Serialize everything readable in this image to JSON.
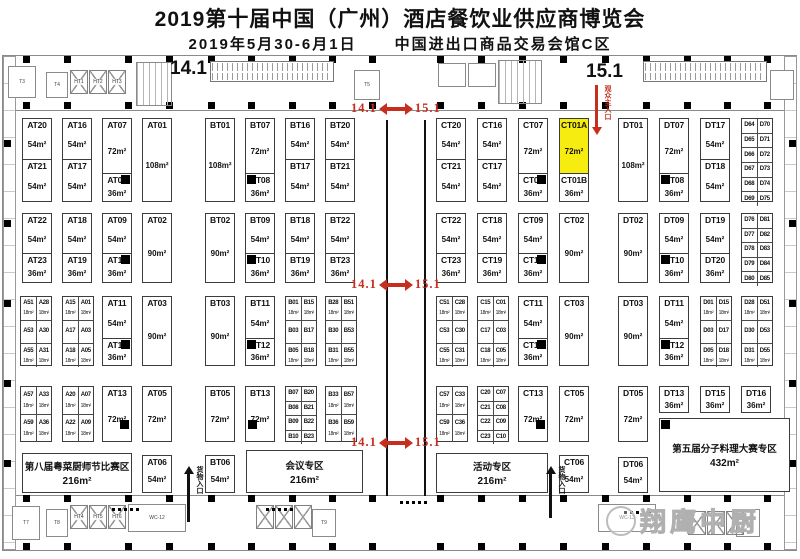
{
  "title": "2019第十届中国（广州）酒店餐饮业供应商博览会",
  "date": "2019年5月30-6月1日",
  "venue": "中国进出口商品交易会馆C区",
  "halls": {
    "left": "14.1",
    "right": "15.1"
  },
  "watermark": "翔鹰中厨",
  "markers": {
    "label_left": "14.1",
    "label_right": "15.1",
    "positions": [
      {
        "x": 351,
        "y": 101
      },
      {
        "x": 351,
        "y": 277
      },
      {
        "x": 351,
        "y": 435
      }
    ]
  },
  "entrances": {
    "main": {
      "label": "观众主入口",
      "x": 592,
      "y": 85,
      "h": 50
    },
    "goods": [
      {
        "label": "货物入口",
        "x": 184,
        "y": 466,
        "h": 56
      },
      {
        "label": "货物入口",
        "x": 546,
        "y": 466,
        "h": 52
      }
    ]
  },
  "zones": [
    {
      "label": "第八届粤菜厨师节比赛区",
      "size": "216m²",
      "x": 22,
      "y": 453,
      "w": 110,
      "h": 40
    },
    {
      "label": "会议专区",
      "size": "216m²",
      "x": 246,
      "y": 450,
      "w": 117,
      "h": 43
    },
    {
      "label": "活动专区",
      "size": "216m²",
      "x": 436,
      "y": 453,
      "w": 112,
      "h": 40
    },
    {
      "label": "第五届分子料理大赛专区",
      "size": "432m²",
      "x": 659,
      "y": 418,
      "w": 131,
      "h": 74,
      "pillar": "tl"
    }
  ],
  "booths": [
    {
      "id": "AT20",
      "size": "54m²",
      "x": 22,
      "y": 118,
      "w": 30,
      "h": 42
    },
    {
      "id": "AT21",
      "size": "54m²",
      "x": 22,
      "y": 159,
      "w": 30,
      "h": 43
    },
    {
      "id": "AT16",
      "size": "54m²",
      "x": 62,
      "y": 118,
      "w": 30,
      "h": 42
    },
    {
      "id": "AT17",
      "size": "54m²",
      "x": 62,
      "y": 159,
      "w": 30,
      "h": 43
    },
    {
      "id": "AT07",
      "size": "72m²",
      "x": 102,
      "y": 118,
      "w": 30,
      "h": 56
    },
    {
      "id": "AT08",
      "size": "36m²",
      "x": 102,
      "y": 173,
      "w": 30,
      "h": 29,
      "pillar": "tr"
    },
    {
      "id": "AT01",
      "size": "108m²",
      "x": 142,
      "y": 118,
      "w": 30,
      "h": 84
    },
    {
      "id": "AT22",
      "size": "54m²",
      "x": 22,
      "y": 213,
      "w": 30,
      "h": 41
    },
    {
      "id": "AT23",
      "size": "36m²",
      "x": 22,
      "y": 253,
      "w": 30,
      "h": 30
    },
    {
      "id": "AT18",
      "size": "54m²",
      "x": 62,
      "y": 213,
      "w": 30,
      "h": 41
    },
    {
      "id": "AT19",
      "size": "36m²",
      "x": 62,
      "y": 253,
      "w": 30,
      "h": 30
    },
    {
      "id": "AT09",
      "size": "54m²",
      "x": 102,
      "y": 213,
      "w": 30,
      "h": 41
    },
    {
      "id": "AT10",
      "size": "36m²",
      "x": 102,
      "y": 253,
      "w": 30,
      "h": 30,
      "pillar": "tr"
    },
    {
      "id": "AT02",
      "size": "90m²",
      "x": 142,
      "y": 213,
      "w": 30,
      "h": 70
    },
    {
      "id": "AT11",
      "size": "54m²",
      "x": 102,
      "y": 296,
      "w": 30,
      "h": 43
    },
    {
      "id": "AT12",
      "size": "36m²",
      "x": 102,
      "y": 338,
      "w": 30,
      "h": 28,
      "pillar": "tr"
    },
    {
      "id": "AT03",
      "size": "90m²",
      "x": 142,
      "y": 296,
      "w": 30,
      "h": 70
    },
    {
      "id": "AT13",
      "size": "72m²",
      "x": 102,
      "y": 386,
      "w": 30,
      "h": 56,
      "pillar": "br"
    },
    {
      "id": "AT05",
      "size": "72m²",
      "x": 142,
      "y": 386,
      "w": 30,
      "h": 56
    },
    {
      "id": "AT06",
      "size": "54m²",
      "x": 142,
      "y": 455,
      "w": 30,
      "h": 38
    },
    {
      "id": "BT01",
      "size": "108m²",
      "x": 205,
      "y": 118,
      "w": 30,
      "h": 84
    },
    {
      "id": "BT07",
      "size": "72m²",
      "x": 245,
      "y": 118,
      "w": 30,
      "h": 56
    },
    {
      "id": "BT08",
      "size": "36m²",
      "x": 245,
      "y": 173,
      "w": 30,
      "h": 29,
      "pillar": "tl"
    },
    {
      "id": "BT16",
      "size": "54m²",
      "x": 285,
      "y": 118,
      "w": 30,
      "h": 42
    },
    {
      "id": "BT17",
      "size": "54m²",
      "x": 285,
      "y": 159,
      "w": 30,
      "h": 43
    },
    {
      "id": "BT20",
      "size": "54m²",
      "x": 325,
      "y": 118,
      "w": 30,
      "h": 42
    },
    {
      "id": "BT21",
      "size": "54m²",
      "x": 325,
      "y": 159,
      "w": 30,
      "h": 43
    },
    {
      "id": "BT02",
      "size": "90m²",
      "x": 205,
      "y": 213,
      "w": 30,
      "h": 70
    },
    {
      "id": "BT09",
      "size": "54m²",
      "x": 245,
      "y": 213,
      "w": 30,
      "h": 41
    },
    {
      "id": "BT10",
      "size": "36m²",
      "x": 245,
      "y": 253,
      "w": 30,
      "h": 30,
      "pillar": "tl"
    },
    {
      "id": "BT18",
      "size": "54m²",
      "x": 285,
      "y": 213,
      "w": 30,
      "h": 41
    },
    {
      "id": "BT19",
      "size": "36m²",
      "x": 285,
      "y": 253,
      "w": 30,
      "h": 30
    },
    {
      "id": "BT22",
      "size": "54m²",
      "x": 325,
      "y": 213,
      "w": 30,
      "h": 41
    },
    {
      "id": "BT23",
      "size": "36m²",
      "x": 325,
      "y": 253,
      "w": 30,
      "h": 30
    },
    {
      "id": "BT03",
      "size": "90m²",
      "x": 205,
      "y": 296,
      "w": 30,
      "h": 70
    },
    {
      "id": "BT11",
      "size": "54m²",
      "x": 245,
      "y": 296,
      "w": 30,
      "h": 43
    },
    {
      "id": "BT12",
      "size": "36m²",
      "x": 245,
      "y": 338,
      "w": 30,
      "h": 28,
      "pillar": "tl"
    },
    {
      "id": "BT05",
      "size": "72m²",
      "x": 205,
      "y": 386,
      "w": 30,
      "h": 56
    },
    {
      "id": "BT13",
      "size": "72m²",
      "x": 245,
      "y": 386,
      "w": 30,
      "h": 56,
      "pillar": "bl"
    },
    {
      "id": "BT06",
      "size": "54m²",
      "x": 205,
      "y": 455,
      "w": 30,
      "h": 38
    },
    {
      "id": "CT20",
      "size": "54m²",
      "x": 436,
      "y": 118,
      "w": 30,
      "h": 42
    },
    {
      "id": "CT21",
      "size": "54m²",
      "x": 436,
      "y": 159,
      "w": 30,
      "h": 43
    },
    {
      "id": "CT16",
      "size": "54m²",
      "x": 477,
      "y": 118,
      "w": 30,
      "h": 42
    },
    {
      "id": "CT17",
      "size": "54m²",
      "x": 477,
      "y": 159,
      "w": 30,
      "h": 43
    },
    {
      "id": "CT07",
      "size": "72m²",
      "x": 518,
      "y": 118,
      "w": 30,
      "h": 56
    },
    {
      "id": "CT08",
      "size": "36m²",
      "x": 518,
      "y": 173,
      "w": 30,
      "h": 29,
      "pillar": "tr"
    },
    {
      "id": "CT01A",
      "size": "72m²",
      "x": 559,
      "y": 118,
      "w": 30,
      "h": 56,
      "hl": true
    },
    {
      "id": "CT01B",
      "size": "36m²",
      "x": 559,
      "y": 173,
      "w": 30,
      "h": 29
    },
    {
      "id": "CT22",
      "size": "54m²",
      "x": 436,
      "y": 213,
      "w": 30,
      "h": 41
    },
    {
      "id": "CT23",
      "size": "36m²",
      "x": 436,
      "y": 253,
      "w": 30,
      "h": 30
    },
    {
      "id": "CT18",
      "size": "54m²",
      "x": 477,
      "y": 213,
      "w": 30,
      "h": 41
    },
    {
      "id": "CT19",
      "size": "36m²",
      "x": 477,
      "y": 253,
      "w": 30,
      "h": 30
    },
    {
      "id": "CT09",
      "size": "54m²",
      "x": 518,
      "y": 213,
      "w": 30,
      "h": 41
    },
    {
      "id": "CT10",
      "size": "36m²",
      "x": 518,
      "y": 253,
      "w": 30,
      "h": 30,
      "pillar": "tr"
    },
    {
      "id": "CT02",
      "size": "90m²",
      "x": 559,
      "y": 213,
      "w": 30,
      "h": 70
    },
    {
      "id": "CT11",
      "size": "54m²",
      "x": 518,
      "y": 296,
      "w": 30,
      "h": 43
    },
    {
      "id": "CT12",
      "size": "36m²",
      "x": 518,
      "y": 338,
      "w": 30,
      "h": 28,
      "pillar": "tr"
    },
    {
      "id": "CT03",
      "size": "90m²",
      "x": 559,
      "y": 296,
      "w": 30,
      "h": 70
    },
    {
      "id": "CT13",
      "size": "72m²",
      "x": 518,
      "y": 386,
      "w": 30,
      "h": 56,
      "pillar": "br"
    },
    {
      "id": "CT05",
      "size": "72m²",
      "x": 559,
      "y": 386,
      "w": 30,
      "h": 56
    },
    {
      "id": "CT06",
      "size": "54m²",
      "x": 559,
      "y": 455,
      "w": 30,
      "h": 38
    },
    {
      "id": "DT01",
      "size": "108m²",
      "x": 618,
      "y": 118,
      "w": 30,
      "h": 84
    },
    {
      "id": "DT07",
      "size": "72m²",
      "x": 659,
      "y": 118,
      "w": 30,
      "h": 56
    },
    {
      "id": "DT08",
      "size": "36m²",
      "x": 659,
      "y": 173,
      "w": 30,
      "h": 29,
      "pillar": "tl"
    },
    {
      "id": "DT17",
      "size": "54m²",
      "x": 700,
      "y": 118,
      "w": 30,
      "h": 42
    },
    {
      "id": "DT18",
      "size": "54m²",
      "x": 700,
      "y": 159,
      "w": 30,
      "h": 43
    },
    {
      "id": "DT02",
      "size": "90m²",
      "x": 618,
      "y": 213,
      "w": 30,
      "h": 70
    },
    {
      "id": "DT09",
      "size": "54m²",
      "x": 659,
      "y": 213,
      "w": 30,
      "h": 41
    },
    {
      "id": "DT10",
      "size": "36m²",
      "x": 659,
      "y": 253,
      "w": 30,
      "h": 30,
      "pillar": "tl"
    },
    {
      "id": "DT19",
      "size": "54m²",
      "x": 700,
      "y": 213,
      "w": 30,
      "h": 41
    },
    {
      "id": "DT20",
      "size": "36m²",
      "x": 700,
      "y": 253,
      "w": 30,
      "h": 30
    },
    {
      "id": "DT03",
      "size": "90m²",
      "x": 618,
      "y": 296,
      "w": 30,
      "h": 70
    },
    {
      "id": "DT11",
      "size": "54m²",
      "x": 659,
      "y": 296,
      "w": 30,
      "h": 43
    },
    {
      "id": "DT12",
      "size": "36m²",
      "x": 659,
      "y": 338,
      "w": 30,
      "h": 28,
      "pillar": "tl"
    },
    {
      "id": "DT05",
      "size": "72m²",
      "x": 618,
      "y": 386,
      "w": 30,
      "h": 56
    },
    {
      "id": "DT13",
      "size": "36m²",
      "x": 659,
      "y": 386,
      "w": 30,
      "h": 27
    },
    {
      "id": "DT15",
      "size": "36m²",
      "x": 700,
      "y": 386,
      "w": 30,
      "h": 27
    },
    {
      "id": "DT16",
      "size": "36m²",
      "x": 741,
      "y": 386,
      "w": 30,
      "h": 27
    },
    {
      "id": "DT06",
      "size": "54m²",
      "x": 618,
      "y": 457,
      "w": 30,
      "h": 36
    }
  ],
  "grids": [
    {
      "x": 20,
      "y": 296,
      "w": 32,
      "h": 70,
      "rows": [
        [
          "A51",
          "A28",
          "18m²"
        ],
        [
          "A53",
          "A30",
          ""
        ],
        [
          "A55",
          "A31",
          "18m²"
        ]
      ]
    },
    {
      "x": 62,
      "y": 296,
      "w": 32,
      "h": 70,
      "rows": [
        [
          "A15",
          "A01",
          "18m²"
        ],
        [
          "A17",
          "A03",
          ""
        ],
        [
          "A18",
          "A05",
          "18m²"
        ]
      ]
    },
    {
      "x": 20,
      "y": 386,
      "w": 32,
      "h": 56,
      "rows": [
        [
          "A57",
          "A33",
          "18m²"
        ],
        [
          "A59",
          "A36",
          "18m²"
        ]
      ]
    },
    {
      "x": 62,
      "y": 386,
      "w": 32,
      "h": 56,
      "rows": [
        [
          "A20",
          "A07",
          "18m²"
        ],
        [
          "A22",
          "A09",
          "18m²"
        ]
      ]
    },
    {
      "x": 285,
      "y": 296,
      "w": 32,
      "h": 70,
      "rows": [
        [
          "B01",
          "B15",
          "18m²"
        ],
        [
          "B03",
          "B17",
          ""
        ],
        [
          "B05",
          "B18",
          "18m²"
        ]
      ]
    },
    {
      "x": 325,
      "y": 296,
      "w": 32,
      "h": 70,
      "rows": [
        [
          "B28",
          "B51",
          "18m²"
        ],
        [
          "B30",
          "B53",
          ""
        ],
        [
          "B31",
          "B55",
          "18m²"
        ]
      ]
    },
    {
      "x": 285,
      "y": 386,
      "w": 32,
      "h": 56,
      "rows": [
        [
          "B07",
          "B20",
          ""
        ],
        [
          "B08",
          "B21",
          ""
        ],
        [
          "B09",
          "B22",
          ""
        ],
        [
          "B10",
          "B23",
          ""
        ]
      ]
    },
    {
      "x": 325,
      "y": 386,
      "w": 32,
      "h": 56,
      "rows": [
        [
          "B33",
          "B57",
          "18m²"
        ],
        [
          "B36",
          "B59",
          "18m²"
        ]
      ]
    },
    {
      "x": 436,
      "y": 296,
      "w": 32,
      "h": 70,
      "rows": [
        [
          "C51",
          "C28",
          "18m²"
        ],
        [
          "C53",
          "C30",
          ""
        ],
        [
          "C55",
          "C31",
          "18m²"
        ]
      ]
    },
    {
      "x": 477,
      "y": 296,
      "w": 32,
      "h": 70,
      "rows": [
        [
          "C15",
          "C01",
          "18m²"
        ],
        [
          "C17",
          "C03",
          ""
        ],
        [
          "C18",
          "C05",
          "18m²"
        ]
      ]
    },
    {
      "x": 436,
      "y": 386,
      "w": 32,
      "h": 56,
      "rows": [
        [
          "C57",
          "C33",
          "18m²"
        ],
        [
          "C59",
          "C36",
          "18m²"
        ]
      ]
    },
    {
      "x": 477,
      "y": 386,
      "w": 32,
      "h": 56,
      "rows": [
        [
          "C20",
          "C07",
          ""
        ],
        [
          "C21",
          "C08",
          ""
        ],
        [
          "C22",
          "C09",
          ""
        ],
        [
          "C23",
          "C10",
          ""
        ]
      ]
    },
    {
      "x": 700,
      "y": 296,
      "w": 32,
      "h": 70,
      "rows": [
        [
          "D01",
          "D15",
          "18m²"
        ],
        [
          "D03",
          "D17",
          ""
        ],
        [
          "D05",
          "D18",
          "18m²"
        ]
      ]
    },
    {
      "x": 741,
      "y": 296,
      "w": 32,
      "h": 70,
      "rows": [
        [
          "D28",
          "D51",
          "18m²"
        ],
        [
          "D30",
          "D53",
          ""
        ],
        [
          "D31",
          "D55",
          "18m²"
        ]
      ]
    },
    {
      "x": 741,
      "y": 118,
      "w": 32,
      "h": 84,
      "rows": [
        [
          "D64",
          "D70",
          ""
        ],
        [
          "D65",
          "D71",
          ""
        ],
        [
          "D66",
          "D72",
          ""
        ],
        [
          "D67",
          "D73",
          ""
        ],
        [
          "D68",
          "D74",
          ""
        ],
        [
          "D69",
          "D75",
          ""
        ]
      ]
    },
    {
      "x": 741,
      "y": 213,
      "w": 32,
      "h": 70,
      "rows": [
        [
          "D76",
          "D81",
          ""
        ],
        [
          "D77",
          "D82",
          ""
        ],
        [
          "D78",
          "D83",
          ""
        ],
        [
          "D79",
          "D84",
          ""
        ],
        [
          "D80",
          "D85",
          ""
        ]
      ]
    }
  ],
  "walls": [
    {
      "x": 386,
      "y": 120,
      "h": 376
    },
    {
      "x": 424,
      "y": 120,
      "h": 376
    }
  ],
  "decor": {
    "pillar_xs": [
      23,
      64,
      125,
      166,
      208,
      248,
      289,
      329,
      369,
      437,
      478,
      519,
      560,
      602,
      643,
      684,
      724,
      764
    ],
    "pillar_ys": [
      56,
      102,
      495,
      543
    ],
    "edge_pillar_ys": [
      140,
      220,
      300,
      380,
      460
    ],
    "escalators": [
      {
        "x": 210,
        "y": 61,
        "w": 122,
        "h": 19
      },
      {
        "x": 643,
        "y": 61,
        "w": 122,
        "h": 19
      }
    ],
    "xboxes": [
      {
        "x": 70,
        "y": 70,
        "labels": [
          "HT1",
          "HT2",
          "HT3"
        ]
      },
      {
        "x": 70,
        "y": 505,
        "labels": [
          "HT4",
          "HT5",
          "HT6"
        ]
      },
      {
        "x": 256,
        "y": 505,
        "labels": [
          "",
          "",
          ""
        ]
      },
      {
        "x": 688,
        "y": 511,
        "labels": [
          "",
          "",
          ""
        ]
      }
    ],
    "rooms": [
      {
        "t": "T3",
        "x": 8,
        "y": 66,
        "w": 26,
        "h": 30
      },
      {
        "t": "T4",
        "x": 46,
        "y": 72,
        "w": 20,
        "h": 24
      },
      {
        "t": "",
        "x": 136,
        "y": 62,
        "w": 34,
        "h": 42,
        "grid": true
      },
      {
        "t": "T5",
        "x": 354,
        "y": 70,
        "w": 24,
        "h": 28
      },
      {
        "t": "",
        "x": 438,
        "y": 63,
        "w": 26,
        "h": 22
      },
      {
        "t": "",
        "x": 468,
        "y": 63,
        "w": 26,
        "h": 22
      },
      {
        "t": "",
        "x": 498,
        "y": 60,
        "w": 42,
        "h": 42,
        "grid": true
      },
      {
        "t": "",
        "x": 770,
        "y": 70,
        "w": 22,
        "h": 28
      },
      {
        "t": "T7",
        "x": 12,
        "y": 506,
        "w": 26,
        "h": 32
      },
      {
        "t": "T8",
        "x": 46,
        "y": 509,
        "w": 20,
        "h": 26
      },
      {
        "t": "WC-12",
        "x": 128,
        "y": 504,
        "w": 56,
        "h": 26
      },
      {
        "t": "T9",
        "x": 312,
        "y": 509,
        "w": 22,
        "h": 26
      },
      {
        "t": "WC-13",
        "x": 598,
        "y": 504,
        "w": 56,
        "h": 26
      },
      {
        "t": "T10",
        "x": 736,
        "y": 509,
        "w": 22,
        "h": 26
      }
    ],
    "dot_rows": [
      {
        "x": 112,
        "y": 508
      },
      {
        "x": 266,
        "y": 508
      },
      {
        "x": 400,
        "y": 501
      },
      {
        "x": 624,
        "y": 511
      }
    ]
  }
}
